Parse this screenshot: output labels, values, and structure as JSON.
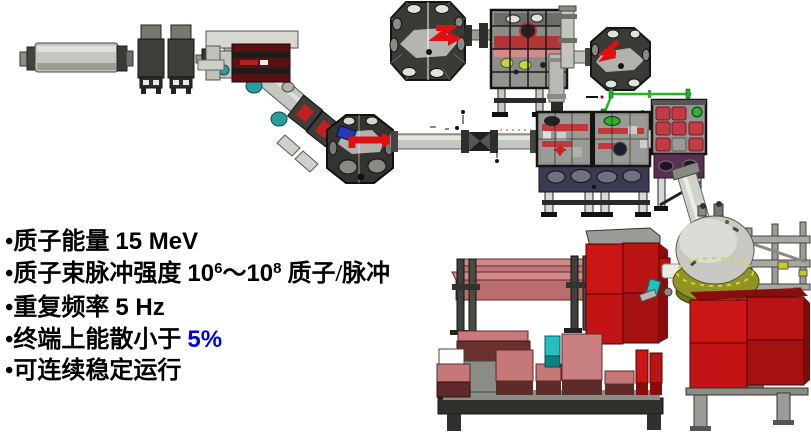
{
  "specs": {
    "lines": [
      {
        "segments": [
          {
            "text": "•质子能量 ",
            "style": "cn"
          },
          {
            "text": "15 MeV",
            "style": "num"
          }
        ]
      },
      {
        "segments": [
          {
            "text": "•质子束脉冲强度 ",
            "style": "cn"
          },
          {
            "text": "10",
            "style": "num"
          },
          {
            "text": "6",
            "style": "sup"
          },
          {
            "text": "～",
            "style": "cn"
          },
          {
            "text": "10",
            "style": "num"
          },
          {
            "text": "8",
            "style": "sup"
          },
          {
            "text": " 质子/脉冲",
            "style": "cn"
          }
        ]
      },
      {
        "segments": [
          {
            "text": "•重复频率 ",
            "style": "cn"
          },
          {
            "text": "5 Hz",
            "style": "num"
          }
        ]
      },
      {
        "segments": [
          {
            "text": "•终端上能散小于 ",
            "style": "cn"
          },
          {
            "text": "5%",
            "style": "accent"
          }
        ]
      },
      {
        "segments": [
          {
            "text": "•可连续稳定运行",
            "style": "cn"
          }
        ]
      }
    ]
  },
  "diagram": {
    "type": "3d-cad-proton-beamline",
    "components": [
      "ion-source",
      "quadrupole-magnets",
      "viewport-beam-pipe",
      "bending-magnet",
      "diagonal-beam-pipe",
      "analysis-chamber-octagon",
      "horizontal-beam-pipe",
      "vacuum-chamber-octagons",
      "caged-instrument-box",
      "experiment-chambers",
      "green-alignment-rails",
      "target-dome-chamber",
      "shielding-blocks",
      "support-frames",
      "shielding-platform"
    ]
  },
  "colors": {
    "accent_blue": "#0000e0",
    "text_black": "#000000",
    "shield_red": "#cc1515",
    "shield_red_dark": "#8a0d0d",
    "shield_salmon": "#c47878",
    "shield_maroon": "#5e2a2a",
    "machine_gray": "#c6c6c1",
    "machine_gray_dark": "#3a3a36",
    "magnet_darkred": "#5c1014",
    "arrow_red": "#e01010",
    "coil_red": "#c02020",
    "port_teal": "#2a9d9d",
    "rail_green": "#27b427",
    "dome_olive": "#8f9422",
    "dome_gray": "#c9c9c3",
    "highlight_cyan": "#22bfbf",
    "band_navy": "#3a3a52",
    "chamber_purple": "#5a3050",
    "lime_dot": "#c8d832"
  }
}
